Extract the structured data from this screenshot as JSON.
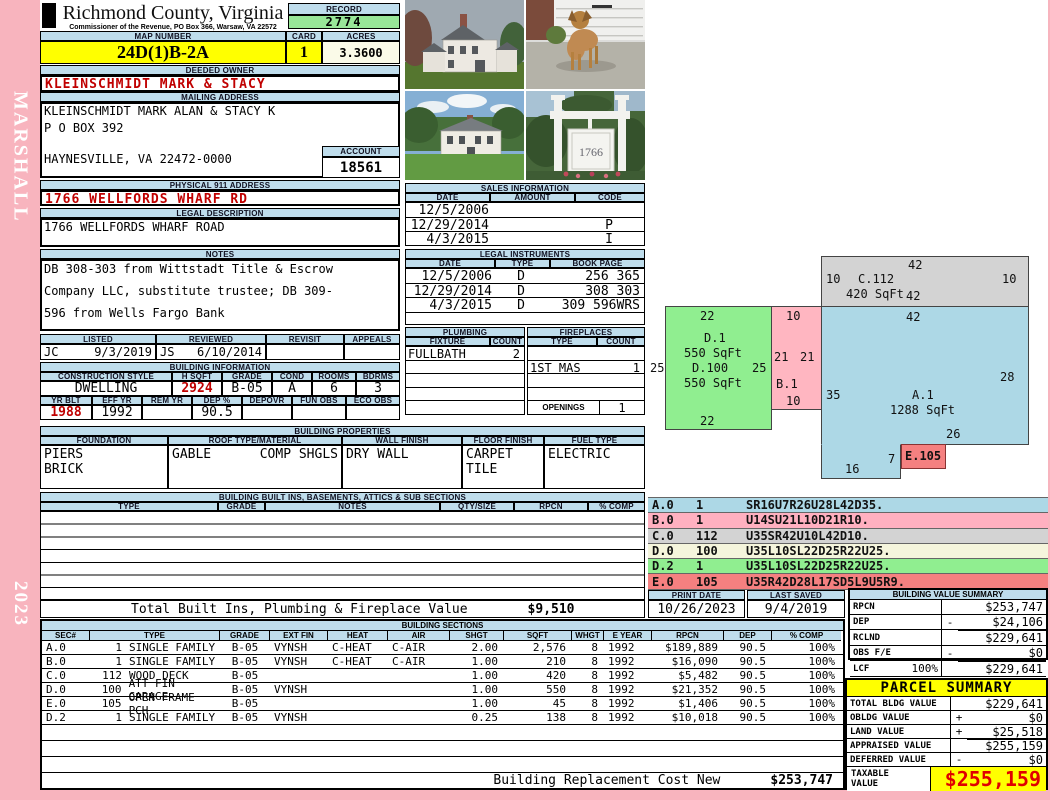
{
  "side": {
    "name": "MARSHALL",
    "year": "2023"
  },
  "colors": {
    "header_blue": "#BFDDEC",
    "highlight_yellow": "#FFFF00",
    "record_green": "#98E698",
    "acres_ivory": "#FAFAE8",
    "red_text": "#C00000",
    "side_pink": "#F8B4BE",
    "sketch_a_blue": "#ADD8E6",
    "sketch_b_pink": "#FFB6C1",
    "sketch_c_gray": "#D3D3D3",
    "sketch_d_cream": "#F5F5DC",
    "sketch_d2_green": "#90EE90",
    "sketch_e_red": "#F58080",
    "taxable_red": "#E00000"
  },
  "header": {
    "county": "Richmond County, Virginia",
    "commissioner": "Commissioner of the Revenue, PO Box 366, Warsaw, VA 22572",
    "record_label": "RECORD",
    "record": "2774",
    "map_label": "MAP NUMBER",
    "map_number": "24D(1)B-2A",
    "card_label": "CARD",
    "card": "1",
    "acres_label": "ACRES",
    "acres": "3.3600"
  },
  "owner_block": {
    "deeded_label": "DEEDED OWNER",
    "deeded_owner": "KLEINSCHMIDT MARK & STACY",
    "mailing_label": "MAILING ADDRESS",
    "mail_line1": "KLEINSCHMIDT MARK ALAN & STACY K",
    "mail_line2": "P O BOX 392",
    "mail_line3": "HAYNESVILLE, VA 22472-0000",
    "account_label": "ACCOUNT",
    "account": "18561",
    "physical_label": "PHYSICAL 911 ADDRESS",
    "physical": "1766 WELLFORDS WHARF RD",
    "legal_label": "LEGAL DESCRIPTION",
    "legal": "1766 WELLFORDS WHARF ROAD",
    "notes_label": "NOTES",
    "notes_line1": "DB 308-303 from Wittstadt Title & Escrow",
    "notes_line2": "Company LLC, substitute trustee; DB 309-",
    "notes_line3": "596 from Wells Fargo Bank"
  },
  "review": {
    "listed_label": "LISTED",
    "listed_by": "JC",
    "listed_date": "9/3/2019",
    "reviewed_label": "REVIEWED",
    "reviewed_by": "JS",
    "reviewed_date": "6/10/2014",
    "revisit_label": "REVISIT",
    "revisit": "",
    "appeals_label": "APPEALS",
    "appeals": ""
  },
  "building_info": {
    "title": "BUILDING INFORMATION",
    "style_label": "CONSTRUCTION STYLE",
    "style": "DWELLING",
    "hsqft_label": "H SQFT",
    "hsqft": "2924",
    "grade_label": "GRADE",
    "grade": "B-05",
    "cond_label": "COND",
    "cond": "A",
    "rooms_label": "ROOMS",
    "rooms": "6",
    "bdrms_label": "BDRMS",
    "bdrms": "3",
    "yrblt_label": "YR BLT",
    "yrblt": "1988",
    "effyr_label": "EFF YR",
    "effyr": "1992",
    "remyr_label": "REM YR",
    "remyr": "",
    "dep_label": "DEP %",
    "dep": "90.5",
    "depovr_label": "DEPOVR",
    "depovr": "",
    "funobs_label": "FUN OBS",
    "funobs": "",
    "ecoobs_label": "ECO OBS",
    "ecoobs": ""
  },
  "building_properties": {
    "title": "BUILDING PROPERTIES",
    "foundation_label": "FOUNDATION",
    "foundation1": "PIERS",
    "foundation2": "BRICK",
    "roof_label": "ROOF TYPE/MATERIAL",
    "roof_type": "GABLE",
    "roof_material": "COMP SHGLS",
    "wall_label": "WALL FINISH",
    "wall": "DRY WALL",
    "floor_label": "FLOOR FINISH",
    "floor1": "CARPET",
    "floor2": "TILE",
    "fuel_label": "FUEL TYPE",
    "fuel": "ELECTRIC"
  },
  "built_ins": {
    "title": "BUILDING BUILT INS, BASEMENTS, ATTICS & SUB SECTIONS",
    "h_type": "TYPE",
    "h_grade": "GRADE",
    "h_notes": "NOTES",
    "h_qty": "QTY/SIZE",
    "h_rpcn": "RPCN",
    "h_comp": "% COMP",
    "total_label": "Total Built Ins, Plumbing & Fireplace Value",
    "total": "$9,510"
  },
  "sales": {
    "title": "SALES INFORMATION",
    "h_date": "DATE",
    "h_amount": "AMOUNT",
    "h_code": "CODE",
    "rows": [
      {
        "date": "12/5/2006",
        "amount": "",
        "code": ""
      },
      {
        "date": "12/29/2014",
        "amount": "",
        "code": "P"
      },
      {
        "date": "4/3/2015",
        "amount": "",
        "code": "I"
      }
    ]
  },
  "instruments": {
    "title": "LEGAL INSTRUMENTS",
    "h_date": "DATE",
    "h_type": "TYPE",
    "h_book": "BOOK PAGE",
    "rows": [
      {
        "date": "12/5/2006",
        "type": "D",
        "book": "256 365"
      },
      {
        "date": "12/29/2014",
        "type": "D",
        "book": "308 303"
      },
      {
        "date": "4/3/2015",
        "type": "D",
        "book": "309 596WRS"
      }
    ]
  },
  "plumbing": {
    "title": "PLUMBING",
    "h_fixture": "FIXTURE",
    "h_count": "COUNT",
    "fixture": "FULLBATH",
    "count": "2"
  },
  "fireplaces": {
    "title": "FIREPLACES",
    "h_type": "TYPE",
    "h_count": "COUNT",
    "type": "1ST MAS",
    "count": "1",
    "openings_label": "OPENINGS",
    "openings": "1"
  },
  "sketch": {
    "a_name": "A.1",
    "a_sqft": "1288 SqFt",
    "a_top": "42",
    "a_left": "35",
    "a_right": "28",
    "a_notch": "26",
    "a_bottom": "16",
    "a_step": "7",
    "b_name": "B.1",
    "b_top": "10",
    "b_left": "21",
    "b_right": "21",
    "b_bottom": "10",
    "c_name": "C.112",
    "c_sqft": "420 SqFt",
    "c_top": "42",
    "c_left": "10",
    "c_right": "10",
    "c_bottom": "42",
    "d_name1": "D.1",
    "d_sqft1": "550 SqFt",
    "d_name2": "D.100",
    "d_sqft2": "550 SqFt",
    "d_top": "22",
    "d_left": "25",
    "d_right": "25",
    "d_bottom": "22",
    "e_name": "E.105"
  },
  "legend": {
    "rows": [
      {
        "sec": "A.0",
        "num": "1",
        "code": "SR16U7R26U28L42D35."
      },
      {
        "sec": "B.0",
        "num": "1",
        "code": "U14SU21L10D21R10."
      },
      {
        "sec": "C.0",
        "num": "112",
        "code": "U35SR42U10L42D10."
      },
      {
        "sec": "D.0",
        "num": "100",
        "code": "U35L10SL22D25R22U25."
      },
      {
        "sec": "D.2",
        "num": "1",
        "code": "U35L10SL22D25R22U25."
      },
      {
        "sec": "E.0",
        "num": "105",
        "code": "U35R42D28L17SD5L9U5R9."
      }
    ]
  },
  "print_info": {
    "print_label": "PRINT DATE",
    "print_date": "10/26/2023",
    "saved_label": "LAST SAVED",
    "saved_date": "9/4/2019"
  },
  "value_summary": {
    "title": "BUILDING VALUE SUMMARY",
    "rpcn_label": "RPCN",
    "rpcn": "$253,747",
    "dep_label": "DEP",
    "dep_op": "-",
    "dep": "$24,106",
    "rclnd_label": "RCLND",
    "rclnd": "$229,641",
    "obs_label": "OBS F/E",
    "obs_op": "-",
    "obs": "$0",
    "lcf_label": "LCF",
    "lcf_pct": "100%",
    "lcf": "$229,641"
  },
  "building_sections": {
    "title": "BUILDING SECTIONS",
    "h_sec": "SEC#",
    "h_type": "TYPE",
    "h_grade": "GRADE",
    "h_ext": "EXT FIN",
    "h_heat": "HEAT",
    "h_air": "AIR",
    "h_shgt": "SHGT",
    "h_sqft": "SQFT",
    "h_whgt": "WHGT",
    "h_eyear": "E YEAR",
    "h_rpcn": "RPCN",
    "h_dep": "DEP",
    "h_comp": "% COMP",
    "rows": [
      {
        "sec": "A.0",
        "num": "1",
        "type": "SINGLE FAMILY",
        "grade": "B-05",
        "ext": "VYNSH",
        "heat": "C-HEAT",
        "air": "C-AIR",
        "shgt": "2.00",
        "sqft": "2,576",
        "whgt": "8",
        "eyear": "1992",
        "rpcn": "$189,889",
        "dep": "90.5",
        "comp": "100%"
      },
      {
        "sec": "B.0",
        "num": "1",
        "type": "SINGLE FAMILY",
        "grade": "B-05",
        "ext": "VYNSH",
        "heat": "C-HEAT",
        "air": "C-AIR",
        "shgt": "1.00",
        "sqft": "210",
        "whgt": "8",
        "eyear": "1992",
        "rpcn": "$16,090",
        "dep": "90.5",
        "comp": "100%"
      },
      {
        "sec": "C.0",
        "num": "112",
        "type": "WOOD DECK",
        "grade": "B-05",
        "ext": "",
        "heat": "",
        "air": "",
        "shgt": "1.00",
        "sqft": "420",
        "whgt": "8",
        "eyear": "1992",
        "rpcn": "$5,482",
        "dep": "90.5",
        "comp": "100%"
      },
      {
        "sec": "D.0",
        "num": "100",
        "type": "ATT FIN GARAGE",
        "grade": "B-05",
        "ext": "VYNSH",
        "heat": "",
        "air": "",
        "shgt": "1.00",
        "sqft": "550",
        "whgt": "8",
        "eyear": "1992",
        "rpcn": "$21,352",
        "dep": "90.5",
        "comp": "100%"
      },
      {
        "sec": "E.0",
        "num": "105",
        "type": "OPEN FRAME PCH",
        "grade": "B-05",
        "ext": "",
        "heat": "",
        "air": "",
        "shgt": "1.00",
        "sqft": "45",
        "whgt": "8",
        "eyear": "1992",
        "rpcn": "$1,406",
        "dep": "90.5",
        "comp": "100%"
      },
      {
        "sec": "D.2",
        "num": "1",
        "type": "SINGLE FAMILY",
        "grade": "B-05",
        "ext": "VYNSH",
        "heat": "",
        "air": "",
        "shgt": "0.25",
        "sqft": "138",
        "whgt": "8",
        "eyear": "1992",
        "rpcn": "$10,018",
        "dep": "90.5",
        "comp": "100%"
      }
    ]
  },
  "replacement": {
    "label": "Building Replacement Cost New",
    "value": "$253,747"
  },
  "parcel": {
    "title": "PARCEL SUMMARY",
    "total_label": "TOTAL BLDG VALUE",
    "total_op": "",
    "total": "$229,641",
    "obldg_label": "OBLDG VALUE",
    "obldg_op": "+",
    "obldg": "$0",
    "land_label": "LAND VALUE",
    "land_op": "+",
    "land": "$25,518",
    "appraised_label": "APPRAISED VALUE",
    "appraised_op": "",
    "appraised": "$255,159",
    "deferred_label": "DEFERRED VALUE",
    "deferred_op": "-",
    "deferred": "$0",
    "taxable_label1": "TAXABLE",
    "taxable_label2": "VALUE",
    "taxable": "$255,159"
  },
  "photos": {
    "sign_text": "1766"
  }
}
